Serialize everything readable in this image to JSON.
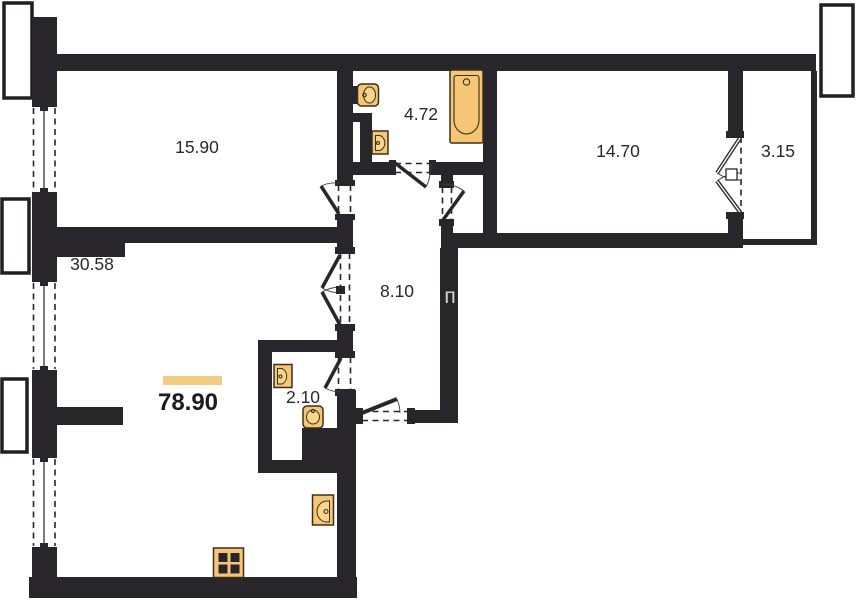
{
  "plan": {
    "type": "apartment-floor-plan",
    "total_area": {
      "value": "78.90"
    },
    "rooms": [
      {
        "name": "room-top-left",
        "area": "15.90"
      },
      {
        "name": "bathroom",
        "area": "4.72"
      },
      {
        "name": "bedroom",
        "area": "14.70"
      },
      {
        "name": "balcony",
        "area": "3.15"
      },
      {
        "name": "living-room",
        "area": "30.58"
      },
      {
        "name": "hallway",
        "area": "8.10"
      },
      {
        "name": "wc",
        "area": "2.10"
      }
    ],
    "fixtures": [
      {
        "name": "bathroom-toilet"
      },
      {
        "name": "bathroom-sink"
      },
      {
        "name": "bathtub"
      },
      {
        "name": "wc-sink"
      },
      {
        "name": "wc-toilet"
      },
      {
        "name": "kitchen-sink"
      },
      {
        "name": "stove"
      }
    ],
    "watermark": "п",
    "colors": {
      "wall": "#29262b",
      "fixture_fill": "#f6c575",
      "fixture_stroke": "#39301c",
      "area_bar": "#f3cc82",
      "label_text": "#29292c",
      "background": "#ffffff"
    }
  }
}
